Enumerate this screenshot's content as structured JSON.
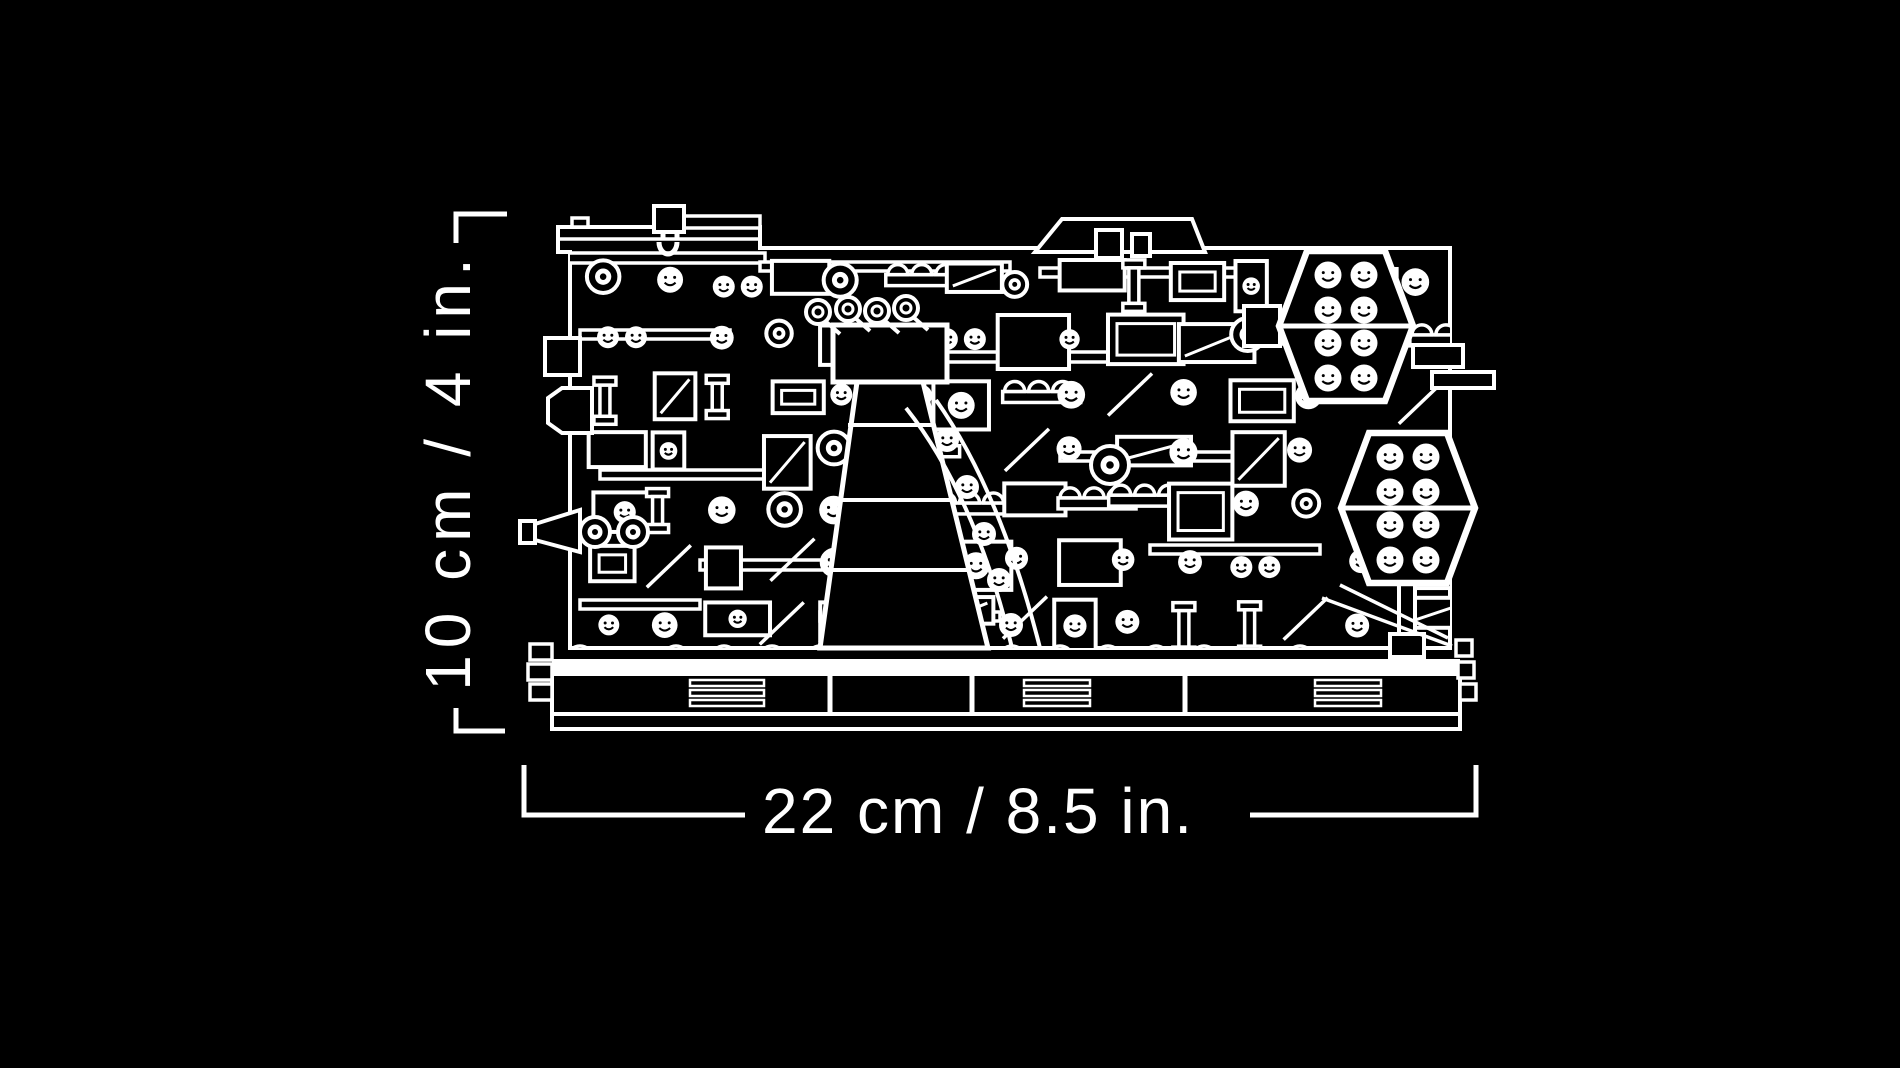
{
  "colors": {
    "background": "#000000",
    "line": "#ffffff"
  },
  "dimensions": {
    "height_label": "10 cm / 4 in.",
    "width_label": "22 cm / 8.5 in."
  },
  "illustration": {
    "icon": "lego-diorama-line-art-icon"
  }
}
